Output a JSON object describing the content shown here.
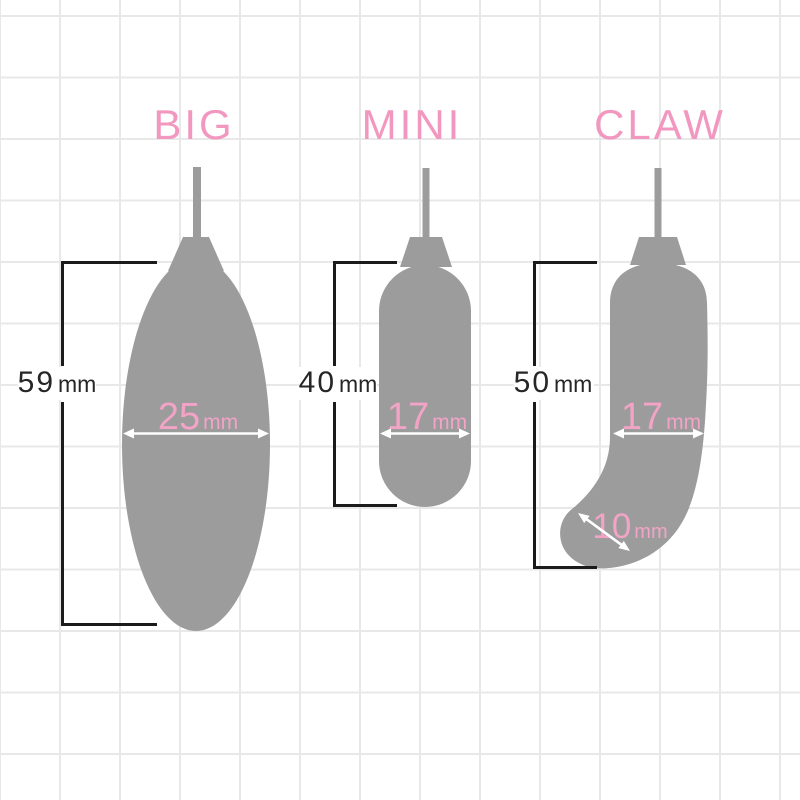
{
  "colors": {
    "background": "#ffffff",
    "grid_line": "#e8e8e8",
    "shape_gray": "#9c9c9c",
    "accent_pink_title": "#f297bf",
    "accent_pink_measure": "#f2a3c6",
    "bracket_black": "#1b1b1b",
    "arrow_white": "#ffffff"
  },
  "figures": [
    {
      "id": "big",
      "title": "BIG",
      "height": {
        "value": "59",
        "unit": "mm"
      },
      "width": {
        "value": "25",
        "unit": "mm"
      }
    },
    {
      "id": "mini",
      "title": "MINI",
      "height": {
        "value": "40",
        "unit": "mm"
      },
      "width": {
        "value": "17",
        "unit": "mm"
      }
    },
    {
      "id": "claw",
      "title": "CLAW",
      "height": {
        "value": "50",
        "unit": "mm"
      },
      "width": {
        "value": "17",
        "unit": "mm"
      },
      "tip_diameter": {
        "value": "10",
        "unit": "mm"
      }
    }
  ]
}
